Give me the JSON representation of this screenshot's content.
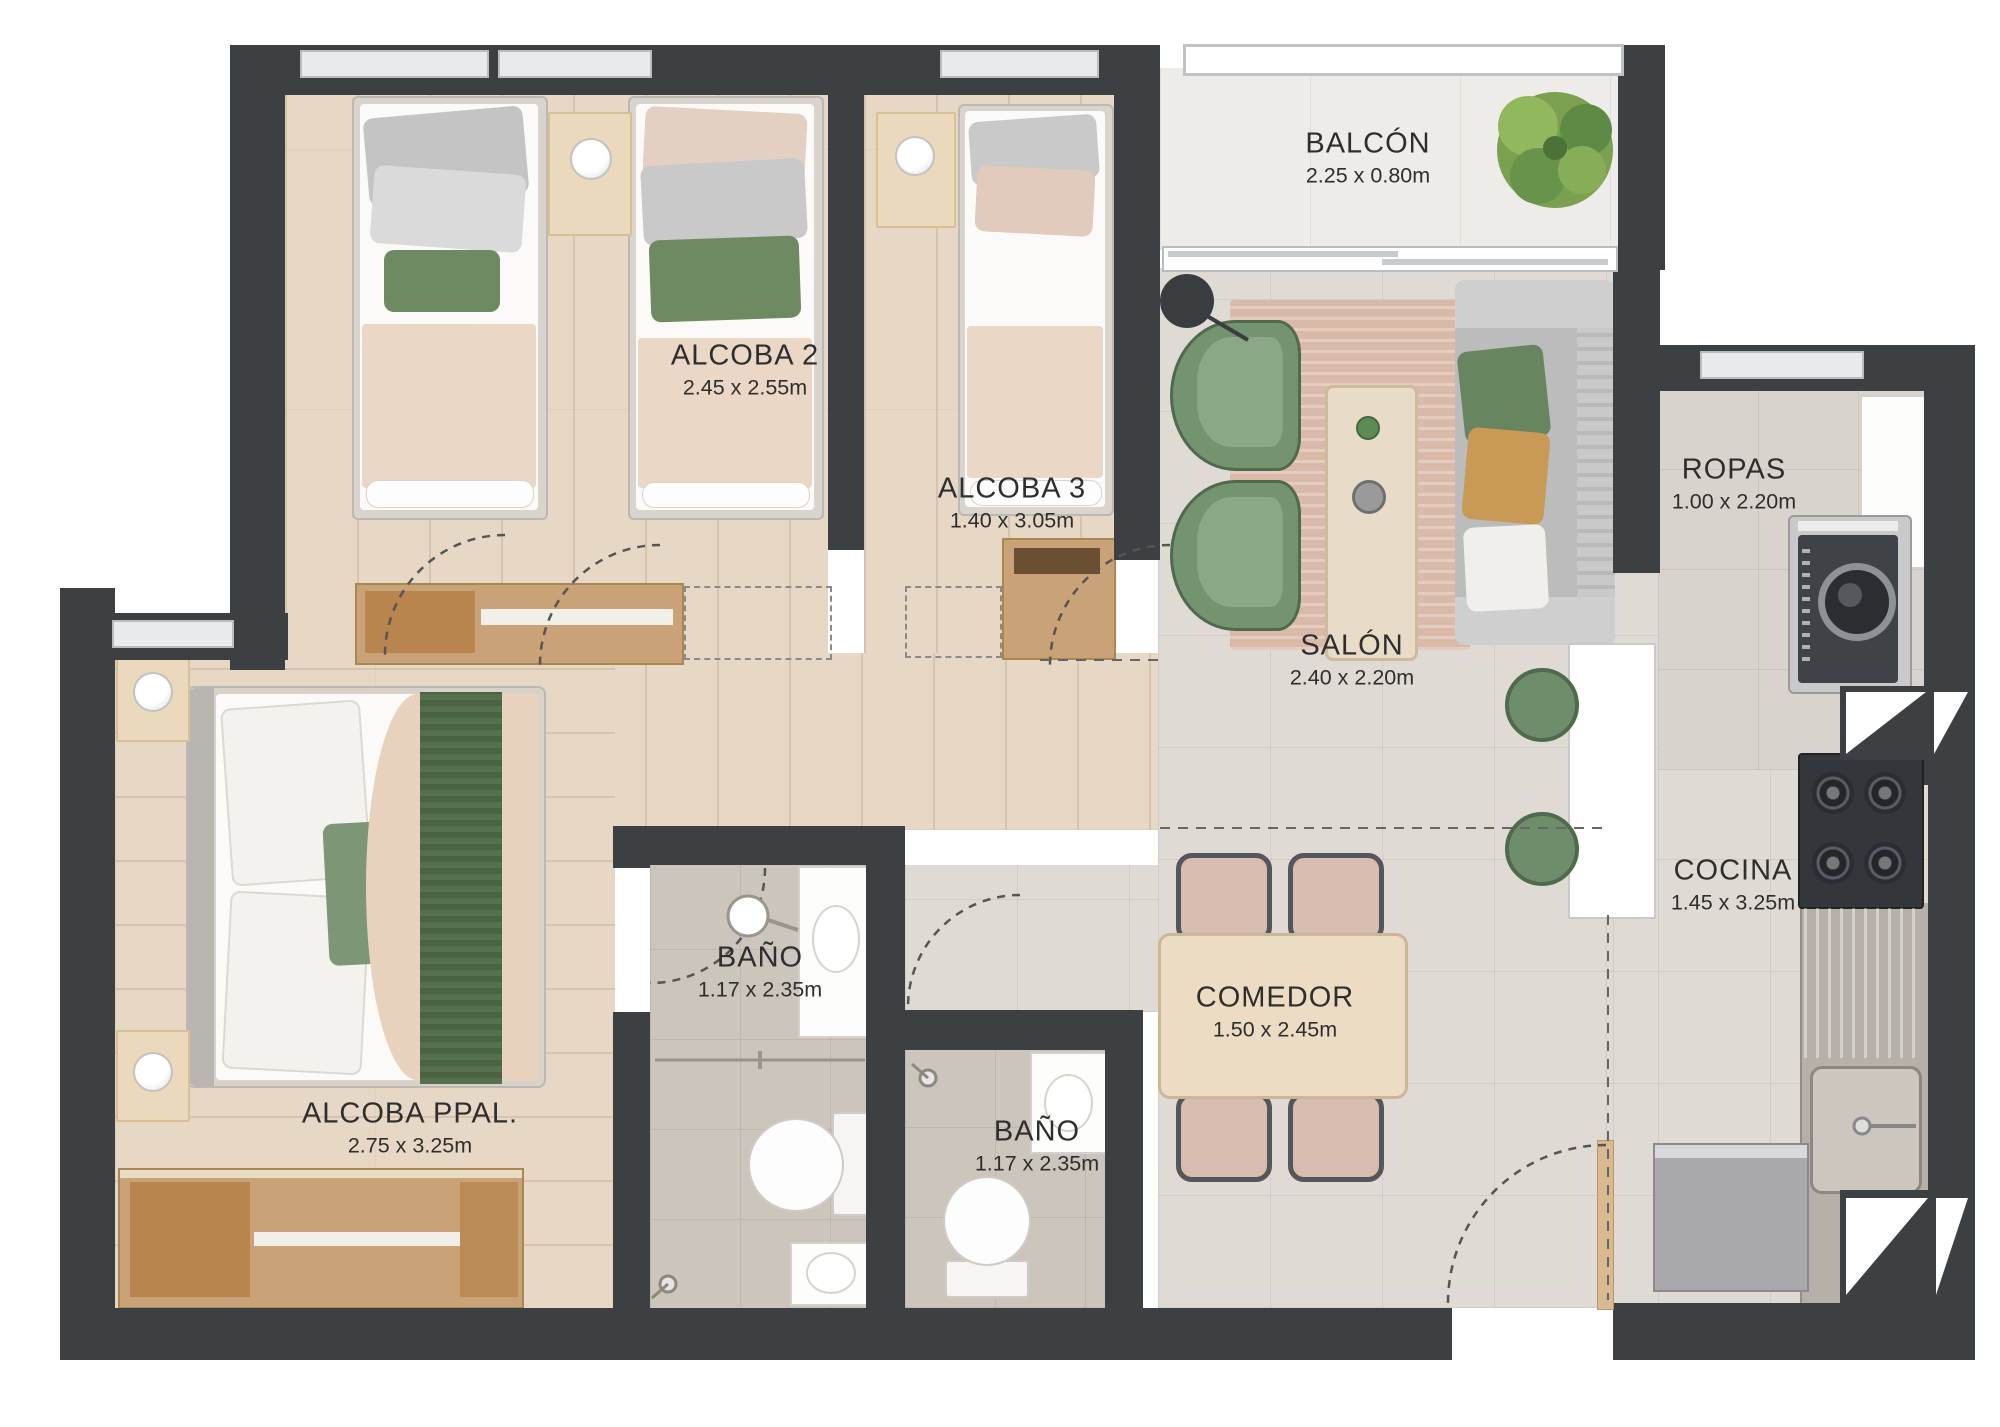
{
  "plan": {
    "title": "Apartment floor plan",
    "rooms": [
      {
        "id": "balcon",
        "label": "BALCÓN",
        "dims": "2.25 x 0.80m"
      },
      {
        "id": "alcoba2",
        "label": "ALCOBA 2",
        "dims": "2.45 x 2.55m"
      },
      {
        "id": "alcoba3",
        "label": "ALCOBA 3",
        "dims": "1.40 x 3.05m"
      },
      {
        "id": "salon",
        "label": "SALÓN",
        "dims": "2.40 x 2.20m"
      },
      {
        "id": "ropas",
        "label": "ROPAS",
        "dims": "1.00 x 2.20m"
      },
      {
        "id": "cocina",
        "label": "COCINA",
        "dims": "1.45 x 3.25m"
      },
      {
        "id": "bano_1",
        "label": "BAÑO",
        "dims": "1.17 x 2.35m"
      },
      {
        "id": "bano_2",
        "label": "BAÑO",
        "dims": "1.17 x 2.35m"
      },
      {
        "id": "comedor",
        "label": "COMEDOR",
        "dims": "1.50 x 2.45m"
      },
      {
        "id": "alcoba_ppal",
        "label": "ALCOBA PPAL.",
        "dims": "2.75 x 3.25m"
      }
    ],
    "colors": {
      "wall": "#3c4043",
      "wood_floor": "#e7d8c6",
      "tile_floor": "#dfdbd4",
      "bath_floor": "#ccc5bc",
      "balcony_floor": "#eeece8",
      "accent_green": "#6e8d6a",
      "throw_green": "#55704c",
      "duvet_beige": "#ead7c6",
      "ochre_pillow": "#c89a56",
      "counter_gray": "#b7b0a9",
      "stove_dark": "#33363a",
      "label_text": "#2e2e2e"
    }
  }
}
